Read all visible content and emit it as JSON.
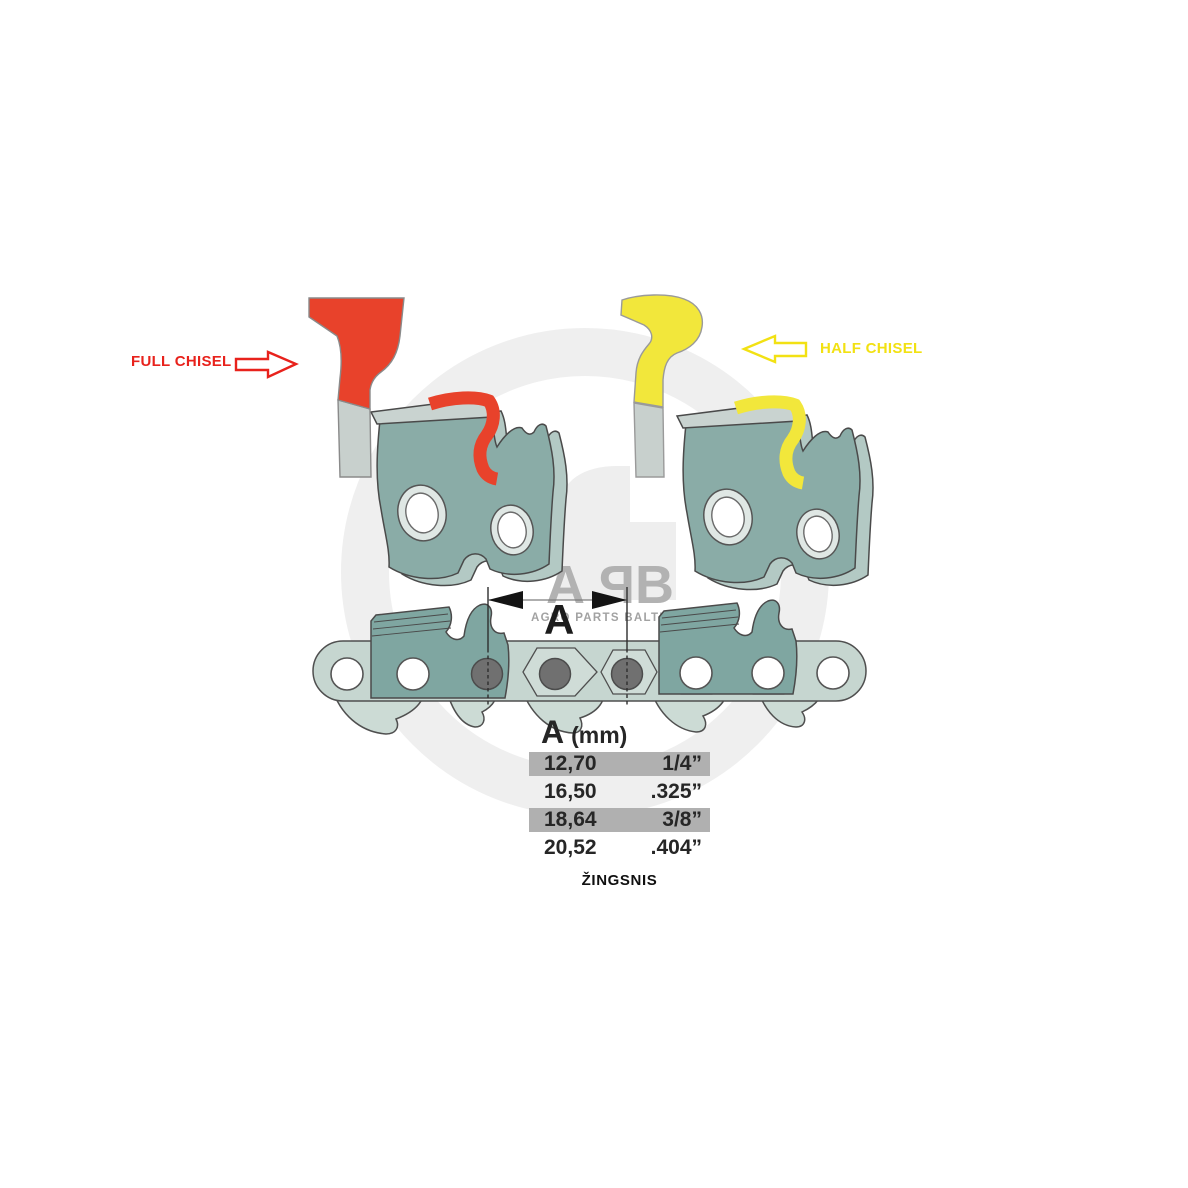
{
  "labels": {
    "full_chisel": "FULL CHISEL",
    "half_chisel": "HALF CHISEL"
  },
  "watermark": {
    "letters": [
      "A",
      "P",
      "B"
    ],
    "subtitle": "AGRO PARTS BALTIJA"
  },
  "dimension": {
    "label": "A"
  },
  "pitch_table": {
    "header_symbol": "A",
    "header_unit": "(mm)",
    "rows": [
      {
        "mm": "12,70",
        "inch": "1/4”",
        "highlighted": true
      },
      {
        "mm": "16,50",
        "inch": ".325”",
        "highlighted": false
      },
      {
        "mm": "18,64",
        "inch": "3/8”",
        "highlighted": true
      },
      {
        "mm": "20,52",
        "inch": ".404”",
        "highlighted": false
      }
    ],
    "caption": "ŽINGSNIS"
  },
  "colors": {
    "full_chisel_red": "#e8422b",
    "full_chisel_text_red": "#e8221c",
    "half_chisel_yellow": "#f2e73b",
    "half_chisel_text_yellow": "#f2e113",
    "link_teal": "#8aaca7",
    "link_teal_dark": "#7fa6a1",
    "link_side": "#b3c9c4",
    "chain_light": "#c6d6d0",
    "drive_link": "#ccdbd5",
    "slab_gray": "#c9d3d0",
    "rivet_gray": "#707070",
    "table_highlight": "#b0b0b0",
    "watermark_gray": "#efefef"
  }
}
